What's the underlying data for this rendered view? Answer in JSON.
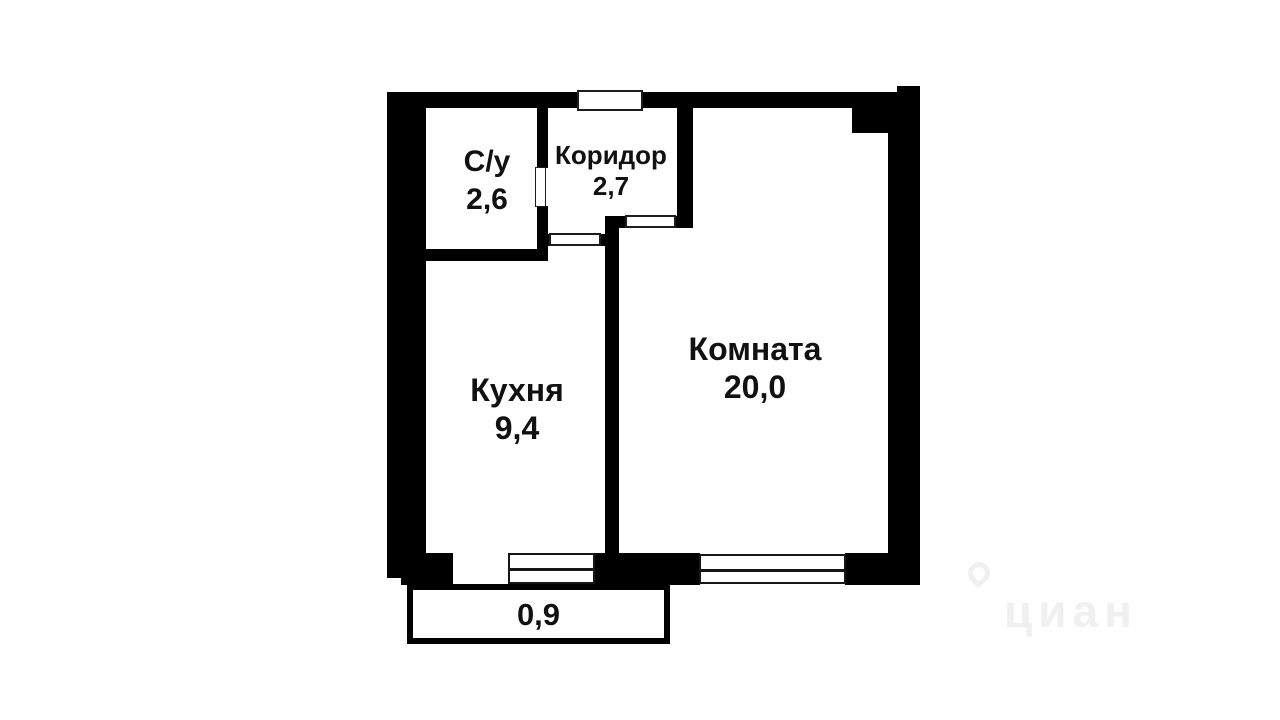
{
  "floor_plan": {
    "rooms": [
      {
        "label": "С/у",
        "area": "2,6"
      },
      {
        "label": "Коридор",
        "area": "2,7"
      },
      {
        "label": "Кухня",
        "area": "9,4"
      },
      {
        "label": "Комната",
        "area": "20,0"
      }
    ],
    "balcony": {
      "area": "0,9"
    },
    "colors": {
      "wall": "#000000",
      "floor": "#ffffff",
      "text": "#111111"
    }
  },
  "watermark": {
    "text": "циан",
    "color": "#f0f0f0"
  }
}
